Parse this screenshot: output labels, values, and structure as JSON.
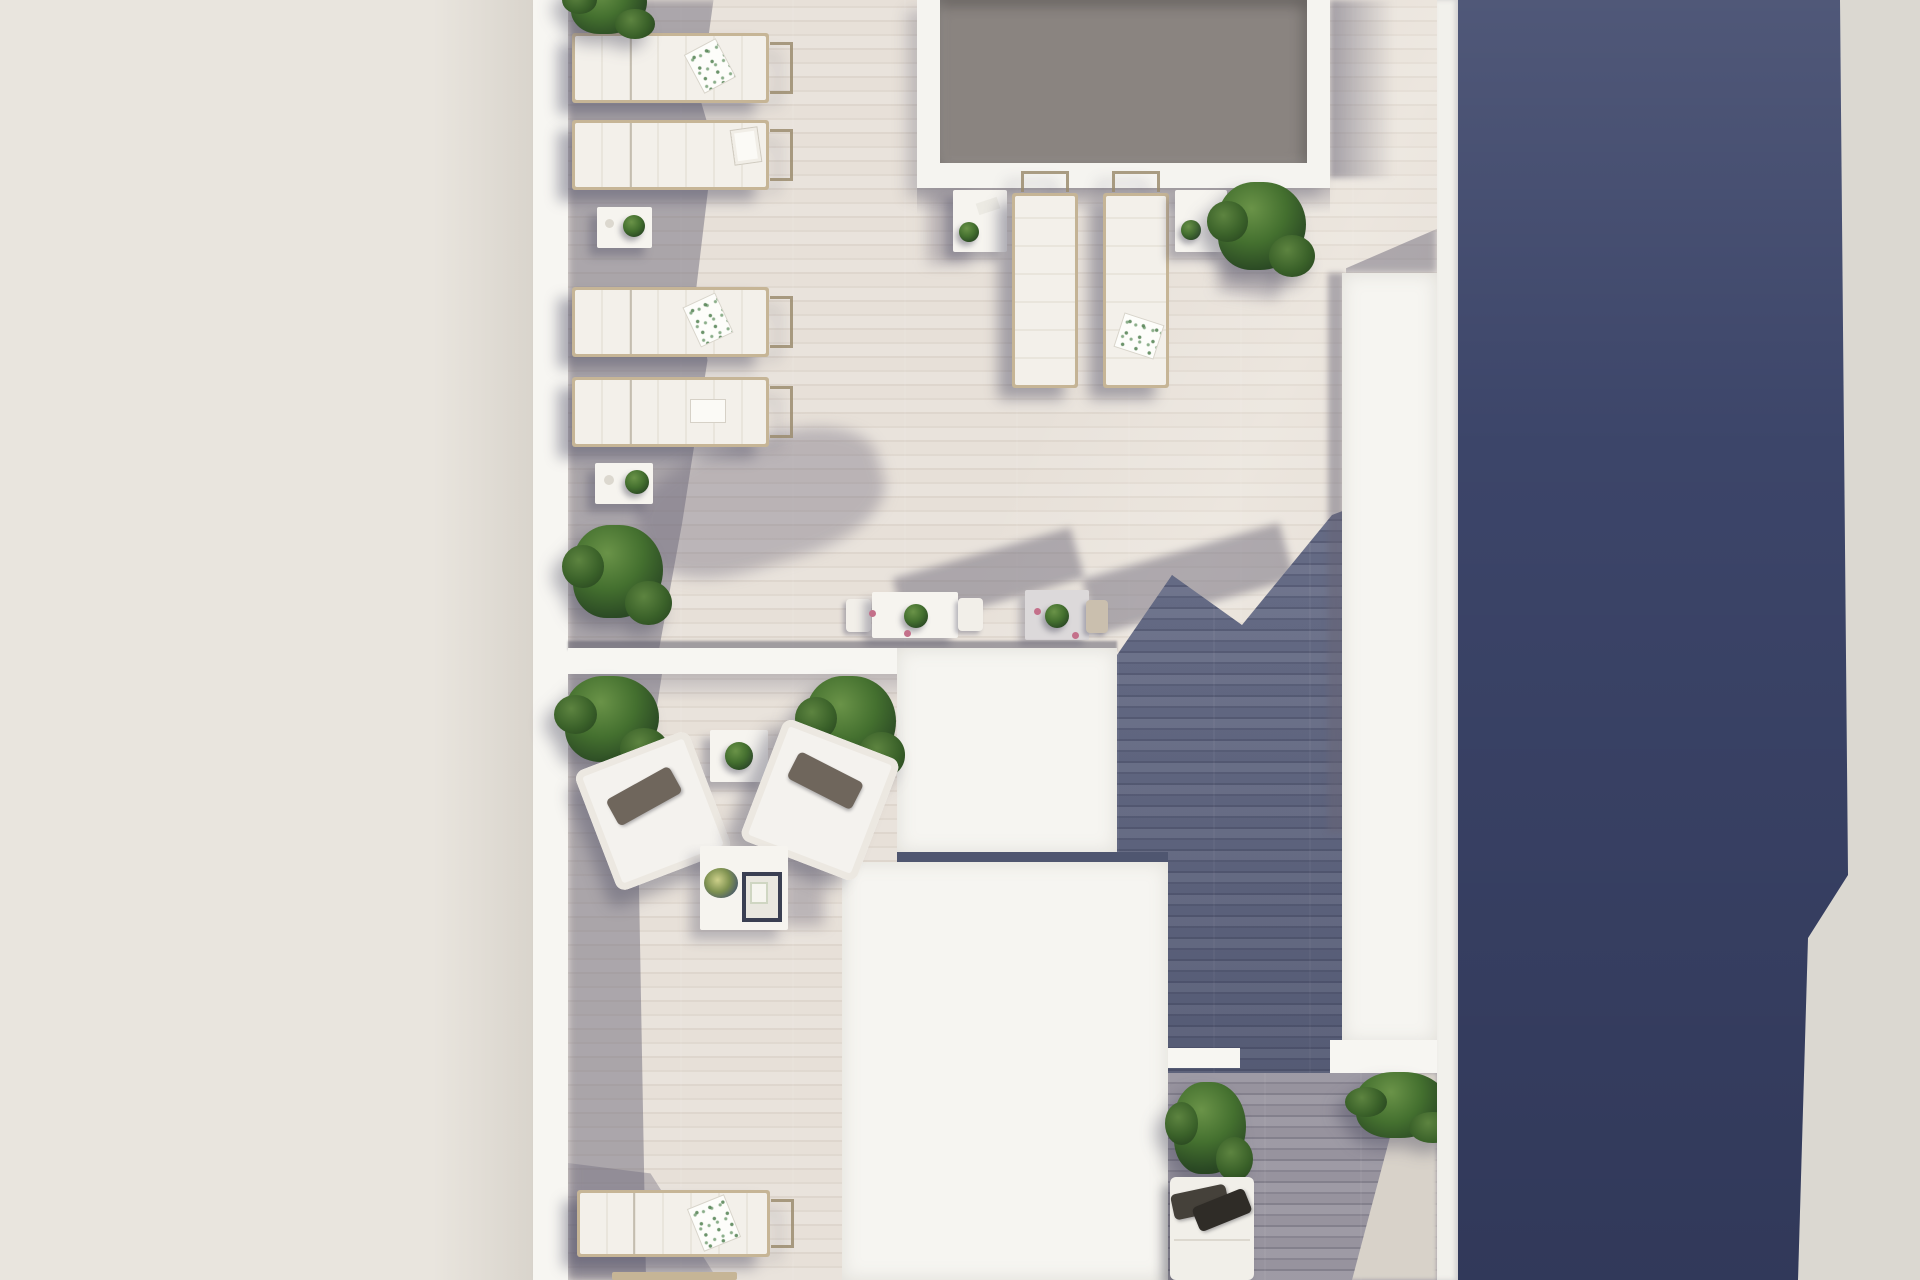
{
  "scene": {
    "type": "3d-architectural-render",
    "view": "top-down aerial",
    "subject": "Rooftop solarium terrace of a modern duplex with plunge pool, sun loungers, dining sets and lounge furniture",
    "lighting": "bright daylight with hard cast shadows",
    "regions": {
      "left": "neighbouring light roof surface",
      "center": "two-level private roof terrace with pale wood-look tiles",
      "right": "dark navy shadowed roof strip with light roof at the far right edge"
    }
  },
  "colors": {
    "outside_left_roof": "#e9e5de",
    "perimeter_wall_white": "#f7f6f2",
    "tile_sunlit": "#e7e0d8",
    "tile_shadow": "#a7a3ad",
    "plank_deep_shadow": "#646a84",
    "lower_shadow_floor": "#97939e",
    "sun_wedge": "#d8d2c9",
    "navy_roof": "#3c4569",
    "outside_right_roof": "#dbd8d1",
    "pool_water": "#8a8480",
    "pool_coping": "#f5f4f0",
    "white_block": "#f6f5f1",
    "divider_wall": "#f7f6f2",
    "lounger_cushion": "#f2efe9",
    "lounger_frame": "#c6b596",
    "pillow_taupe_dark": "#45413a",
    "pillow_taupe_light": "#6f665c",
    "foliage_dark": "#243d1e",
    "foliage_mid": "#44702f",
    "foliage_light": "#6a9348",
    "flower_accent": "#c4708a",
    "tray_frame": "#3a3f52"
  },
  "objects": {
    "pool": {
      "name": "plunge-pool",
      "shape": "rectangular",
      "position": "top centre, cropped by top edge"
    },
    "sun_loungers": {
      "left_column": 4,
      "beside_pool": 2,
      "bottom_terrace": 2,
      "style": "white cushion on light wood frame, some with towels and magazines"
    },
    "side_tables_with_plants": 5,
    "dining_sets": 2,
    "lounge_armchairs": 2,
    "lounge_side_table": 1,
    "coffee_table_with_decor_tray": 1,
    "daybed_with_dark_pillows": 1,
    "bushes": 7,
    "white_roof_volumes": 3
  }
}
